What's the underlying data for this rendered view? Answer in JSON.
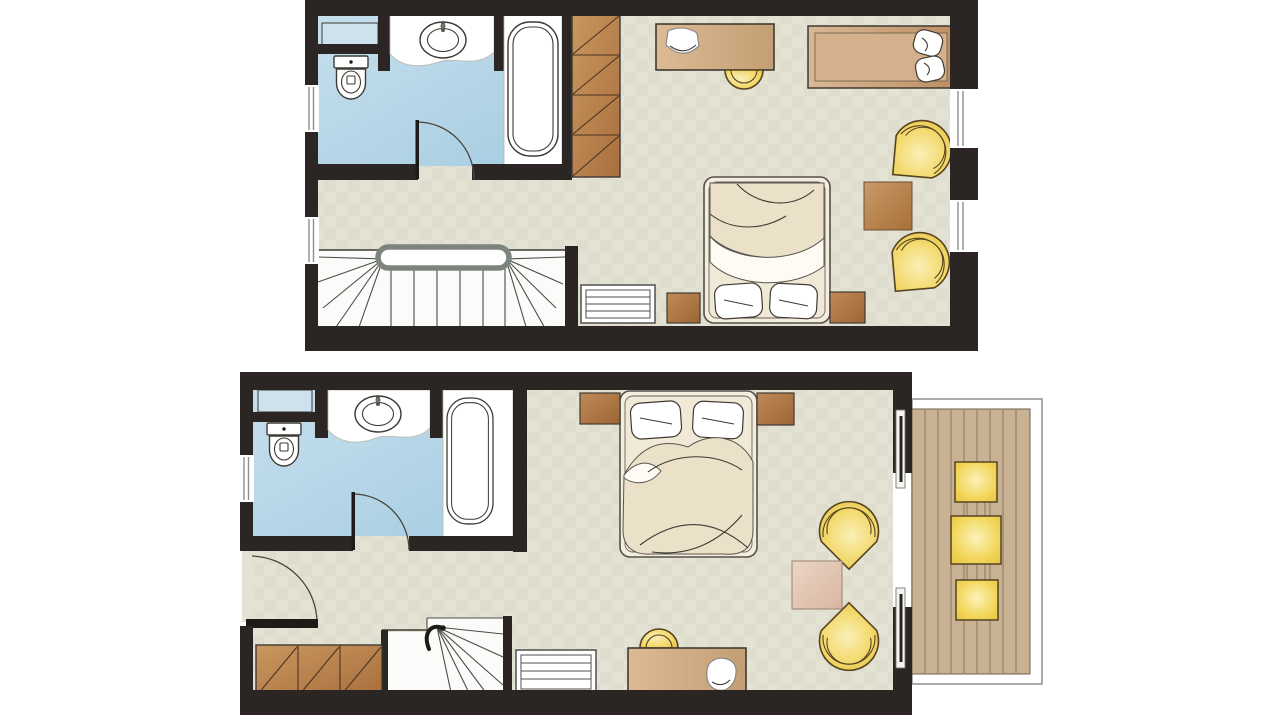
{
  "canvas": {
    "width": 1279,
    "height": 720,
    "background": "#ffffff"
  },
  "palette": {
    "wall": "#2b2623",
    "floor": "#e4e2d3",
    "shelf": "#cde2ed",
    "white": "#ffffff",
    "outline": "#3f3a34",
    "glass": "#8f8f8f",
    "railing": "#7d837d",
    "stairLine": "#4c4c49",
    "radiator": "#4f4f4f",
    "chairOutline": "#564420",
    "deck": "#c9b293",
    "deckLine": "#81725b",
    "linen": "#f3edde",
    "mattress": "#f0e9d7",
    "duvet": "#ebe1c9",
    "sheet": "#fdfbf3",
    "bathFloorLight": "#c6dfed",
    "bathFloorDark": "#a6cde1",
    "woodLight": "#c9975f",
    "woodDark": "#a96f3e",
    "deskLight": "#dcba94",
    "deskDark": "#c49e74",
    "nightLight": "#c08a58",
    "nightDark": "#9c6535",
    "tableLight": "#c89a68",
    "tableDark": "#a87038",
    "pinkLight": "#ecd6c5",
    "pinkDark": "#d9b5a2",
    "sofaLight": "#d9b895",
    "sofaDark": "#bd8f63",
    "chairCenter": "#faf0b8",
    "chairMid": "#f3d96d",
    "chairEdge": "#e3bd40",
    "cushCenter": "#fbf2bb",
    "cushMid": "#f2d75c",
    "cushEdge": "#e8c33e"
  },
  "floors": [
    {
      "id": "upper-floor",
      "position": "top",
      "rooms": [
        {
          "name": "bathroom",
          "features": [
            "wall-shelf",
            "toilet",
            "washbasin-counter",
            "bathtub",
            "bathroom-door"
          ]
        },
        {
          "name": "dressing-area",
          "features": [
            "built-in-wardrobe"
          ]
        },
        {
          "name": "bedroom-living-room",
          "features": [
            "desk",
            "desk-lamp",
            "desk-chair",
            "daybed",
            "armchair",
            "armchair",
            "side-table",
            "double-bed",
            "pillow",
            "pillow",
            "nightstand",
            "nightstand",
            "radiator"
          ]
        },
        {
          "name": "staircase-landing",
          "features": [
            "staircase-down",
            "handrail"
          ]
        }
      ],
      "windows": [
        {
          "wall": "left",
          "count": 2
        },
        {
          "wall": "right",
          "count": 2
        }
      ],
      "doors": [
        "bathroom-door"
      ]
    },
    {
      "id": "lower-floor",
      "position": "bottom",
      "rooms": [
        {
          "name": "bathroom",
          "features": [
            "wall-shelf",
            "toilet",
            "washbasin-counter",
            "bathtub",
            "bathroom-door"
          ]
        },
        {
          "name": "bedroom-living-room",
          "features": [
            "double-bed",
            "pillow",
            "pillow",
            "nightstand",
            "nightstand",
            "armchair",
            "armchair",
            "coffee-table",
            "desk",
            "desk-lamp",
            "desk-chair",
            "radiator"
          ]
        },
        {
          "name": "entry",
          "features": [
            "entrance-door",
            "built-in-wardrobe",
            "winder-staircase-up"
          ]
        },
        {
          "name": "balcony",
          "features": [
            "wood-deck",
            "seat-cushion",
            "table-cushion",
            "seat-cushion",
            "sliding-door"
          ]
        }
      ],
      "windows": [
        {
          "wall": "left",
          "count": 1
        }
      ],
      "doors": [
        "entrance-door",
        "bathroom-door",
        "sliding-balcony-door"
      ]
    }
  ]
}
